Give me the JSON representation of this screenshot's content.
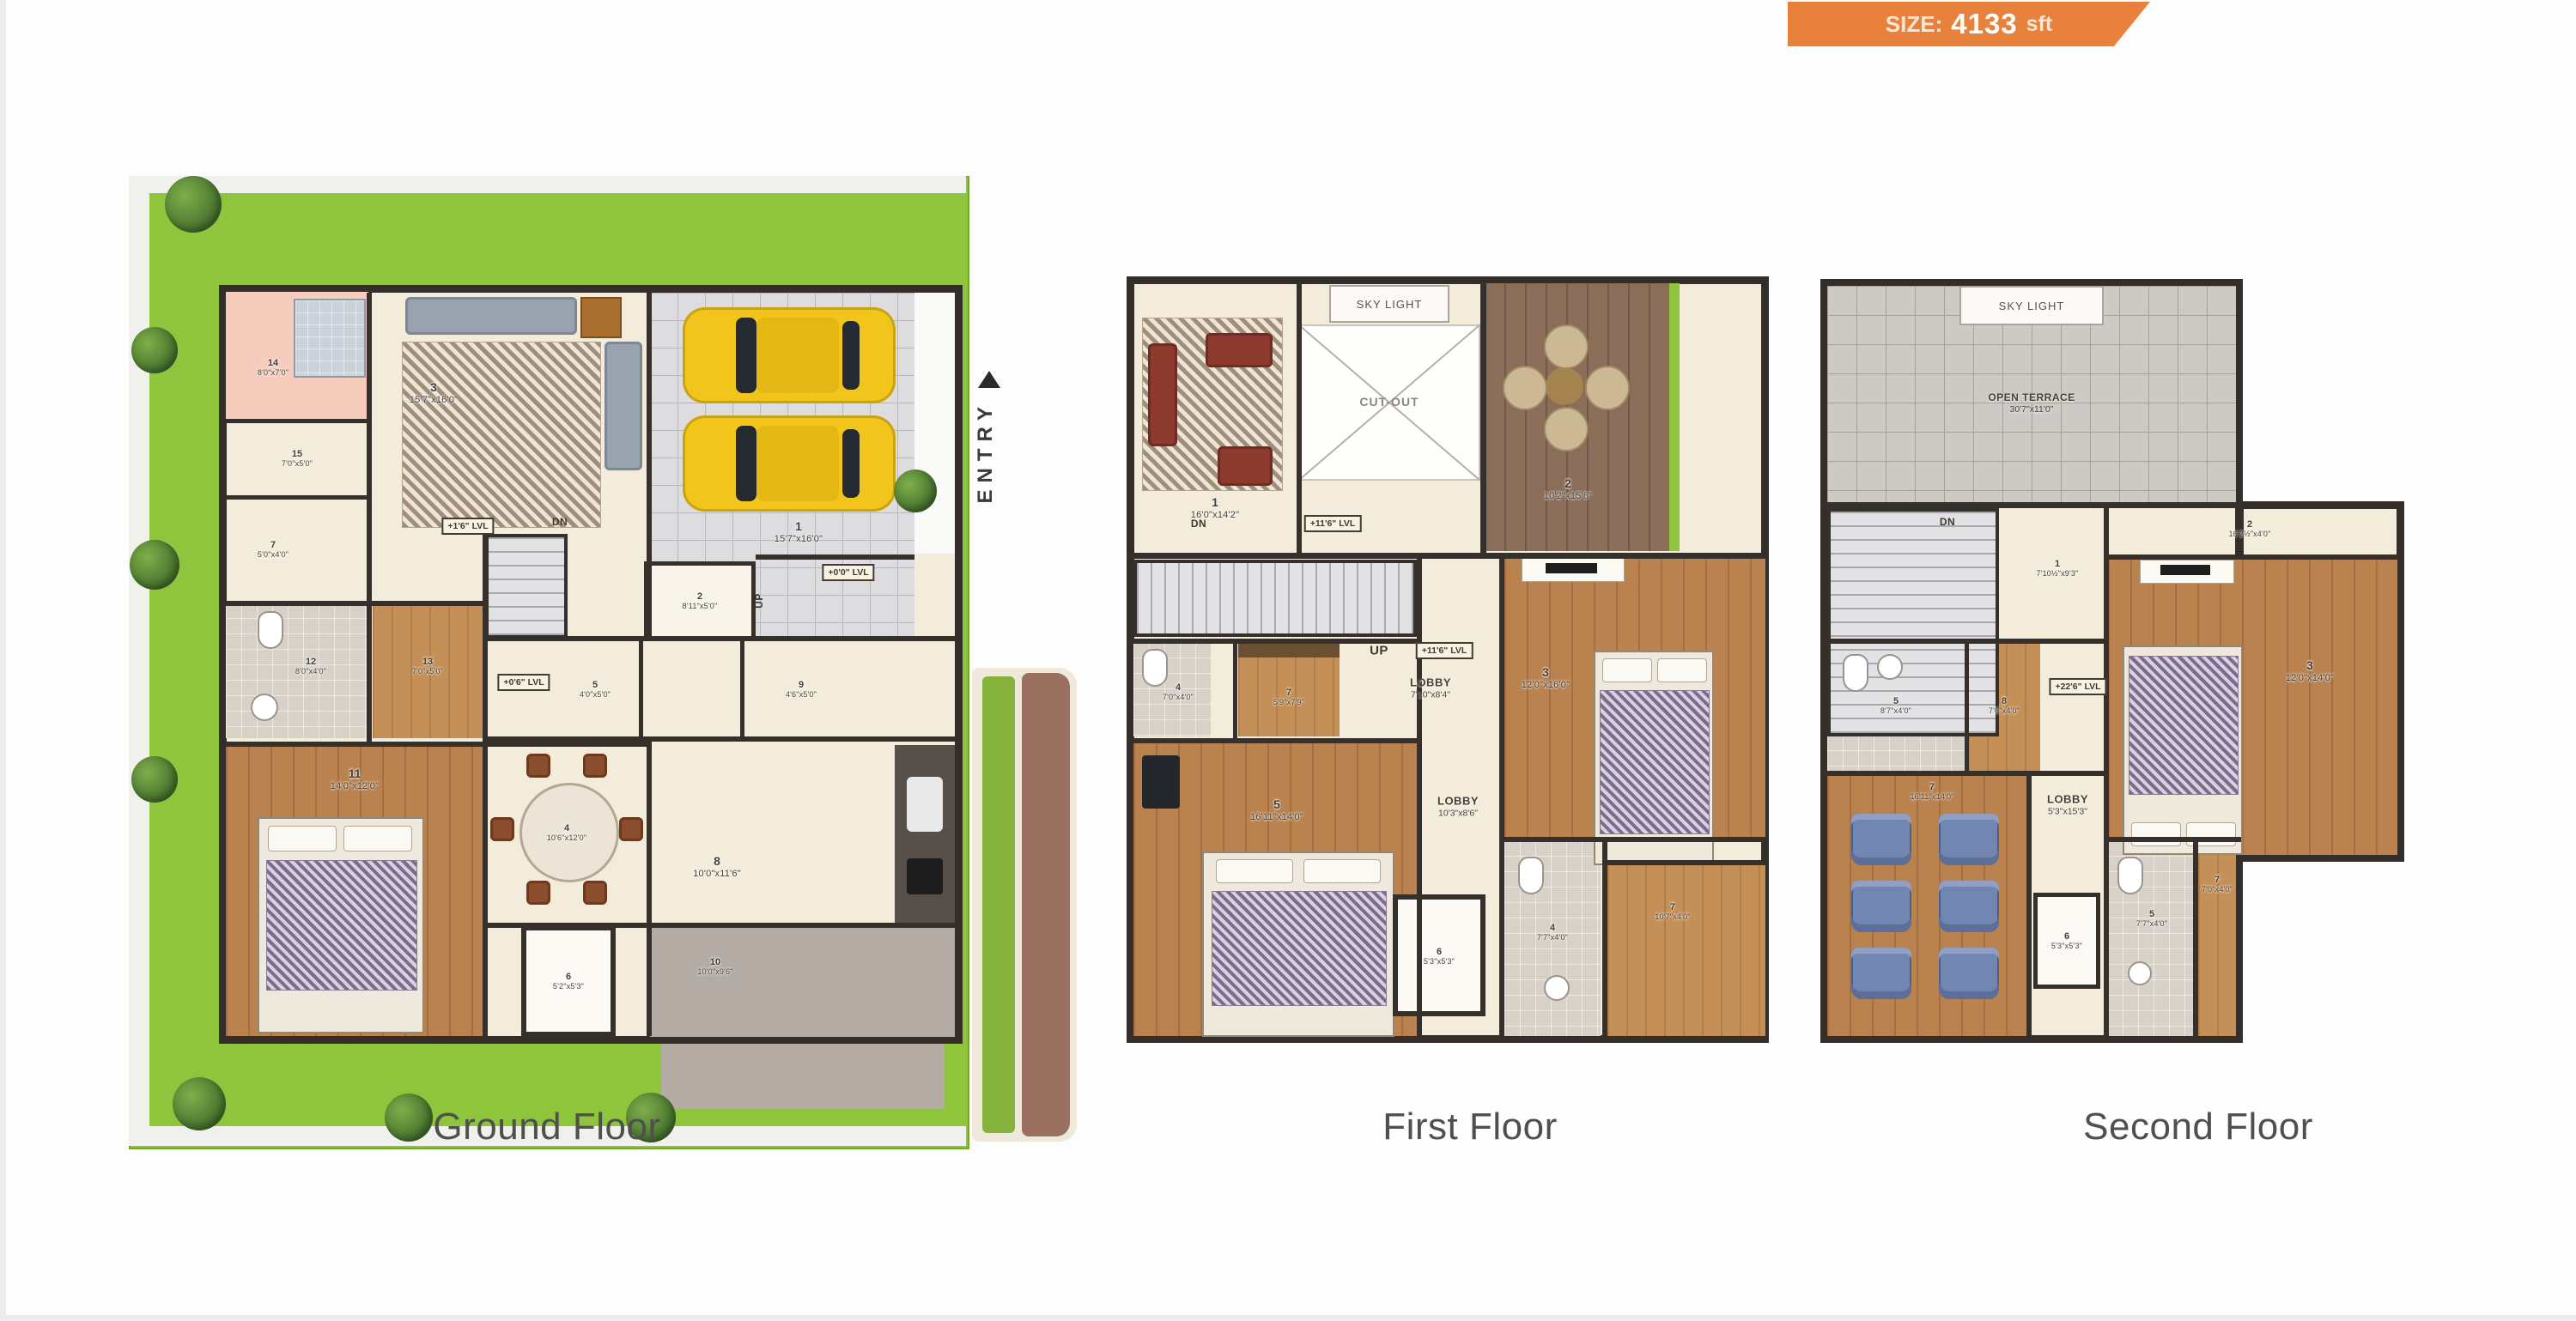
{
  "badge": {
    "size_label": "SIZE:",
    "size_value": "4133",
    "size_unit": "sft"
  },
  "colors": {
    "badge_orange": "#e8813b",
    "lawn_green": "#8fc43d",
    "wall_dark": "#35302b",
    "wood_floor": "#b9824f",
    "car_yellow": "#f2c51d"
  },
  "floors": {
    "ground": {
      "title": "Ground Floor",
      "entry": "ENTRY",
      "up": "UP",
      "dn": "DN",
      "levels": {
        "living": "+1'6\" LVL",
        "garage": "+0'0\" LVL",
        "dining": "+0'6\" LVL"
      },
      "rooms": [
        {
          "num": "1",
          "dims": "15'7\"x16'0\"",
          "name": "car-park"
        },
        {
          "num": "2",
          "dims": "8'11\"x5'0\"",
          "name": "sit-out"
        },
        {
          "num": "3",
          "dims": "15'7\"x16'0\"",
          "name": "living"
        },
        {
          "num": "4",
          "dims": "10'6\"x12'0\"",
          "name": "dining"
        },
        {
          "num": "5",
          "dims": "4'0\"x5'0\""
        },
        {
          "num": "6",
          "dims": "5'2\"x5'3\""
        },
        {
          "num": "7",
          "dims": "5'0\"x4'0\""
        },
        {
          "num": "8",
          "dims": "10'0\"x11'6\"",
          "name": "kitchen"
        },
        {
          "num": "9",
          "dims": "4'6\"x5'0\""
        },
        {
          "num": "10",
          "dims": "10'0\"x9'6\"",
          "name": "utility"
        },
        {
          "num": "11",
          "dims": "14'0\"x12'0\"",
          "name": "bedroom"
        },
        {
          "num": "12",
          "dims": "8'0\"x4'0\"",
          "name": "bath"
        },
        {
          "num": "13",
          "dims": "7'0\"x5'0\"",
          "name": "dress"
        },
        {
          "num": "14",
          "dims": "8'0\"x7'0\"",
          "name": "bath"
        },
        {
          "num": "15",
          "dims": "7'0\"x5'0\""
        }
      ]
    },
    "first": {
      "title": "First Floor",
      "sky_light": "SKY LIGHT",
      "cut_out": "CUT-OUT",
      "up": "UP",
      "dn": "DN",
      "level_up": "+11'6\" LVL",
      "level_stair": "+11'6\" LVL",
      "lobby1": {
        "label": "LOBBY",
        "dims": "7'10\"x8'4\""
      },
      "lobby2": {
        "label": "LOBBY",
        "dims": "10'3\"x8'6\""
      },
      "rooms": [
        {
          "num": "1",
          "dims": "16'0\"x14'2\"",
          "name": "family"
        },
        {
          "num": "2",
          "dims": "10'2\"x15'6\"",
          "name": "sit-out"
        },
        {
          "num": "3",
          "dims": "12'0\"x16'0\"",
          "name": "bedroom"
        },
        {
          "num": "4",
          "dims": "7'0\"x4'0\"",
          "name": "toilet"
        },
        {
          "num": "5",
          "dims": "16'11\"x14'0\"",
          "name": "bedroom"
        },
        {
          "num": "6",
          "dims": "5'3\"x5'3\""
        },
        {
          "num": "7",
          "dims": "5'9\"x7'9\"",
          "name": "dress"
        },
        {
          "num": "4",
          "dims": "7'7\"x4'0\"",
          "name": "toilet"
        },
        {
          "num": "7",
          "dims": "10'7\"x4'0\"",
          "name": "dress"
        }
      ]
    },
    "second": {
      "title": "Second Floor",
      "sky_light": "SKY LIGHT",
      "dn": "DN",
      "open_terrace": {
        "label": "OPEN TERRACE",
        "dims": "30'7\"x11'0\""
      },
      "level": "+22'6\" LVL",
      "lobby": {
        "label": "LOBBY",
        "dims": "5'3\"x15'3\""
      },
      "rooms": [
        {
          "num": "1",
          "dims": "7'10½\"x9'3\"",
          "name": "passage"
        },
        {
          "num": "2",
          "dims": "16'2½\"x4'0\"",
          "name": "closet"
        },
        {
          "num": "3",
          "dims": "12'0\"x14'0\"",
          "name": "bedroom"
        },
        {
          "num": "5",
          "dims": "8'7\"x4'0\"",
          "name": "bath"
        },
        {
          "num": "8",
          "dims": "7'6\"x4'0\"",
          "name": "wardrobe"
        },
        {
          "num": "7",
          "dims": "16'11\"x14'0\"",
          "name": "home-theater"
        },
        {
          "num": "6",
          "dims": "5'3\"x5'3\""
        },
        {
          "num": "5",
          "dims": "7'7\"x4'0\"",
          "name": "toilet"
        },
        {
          "num": "7",
          "dims": "7'0\"x4'0\"",
          "name": "dress"
        }
      ]
    }
  }
}
